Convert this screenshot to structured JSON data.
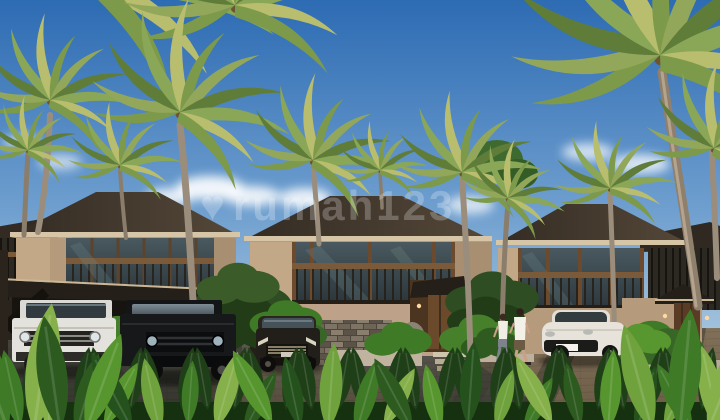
{
  "scene": {
    "watermark": "rumah123",
    "villas": [
      "left-villa",
      "center-villa",
      "right-villa"
    ],
    "vehicles": [
      "white-suv",
      "black-suv",
      "black-mpv",
      "white-crossover"
    ],
    "people": [
      "woman",
      "man"
    ]
  },
  "palette": {
    "sky_top": "#2d6bb3",
    "sky_mid": "#6f9fcf",
    "sky_low": "#d9e6ee",
    "cloud": "#ffffff",
    "roof_dark": "#332b23",
    "roof_lit": "#554839",
    "fascia": "#d6c5a6",
    "wall_lit": "#c3a887",
    "wall_shade": "#a98f72",
    "stone_dark": "#4e463c",
    "stone_mid": "#7e7466",
    "wood": "#7b5a3a",
    "wood_dark": "#4c3520",
    "glass_dark": "#2c373c",
    "glass_light": "#49595f",
    "road_dark": "#38372f",
    "road_light": "#615e55",
    "sun_patch": "#a8885f",
    "leaf_bright": "#6fa23c",
    "leaf_mid": "#3f7a26",
    "leaf_dark": "#24511c",
    "palm_a": "#93a75b",
    "palm_b": "#7d9a4a",
    "palm_c": "#5f7d39",
    "trunk": "#9b8d7b",
    "car_white": "#e4e2dc",
    "car_black": "#17181a",
    "car_mpv": "#221e19",
    "car_porsche": "#e7e3da",
    "chrome": "#c9bb97",
    "skin": "#caa184"
  }
}
